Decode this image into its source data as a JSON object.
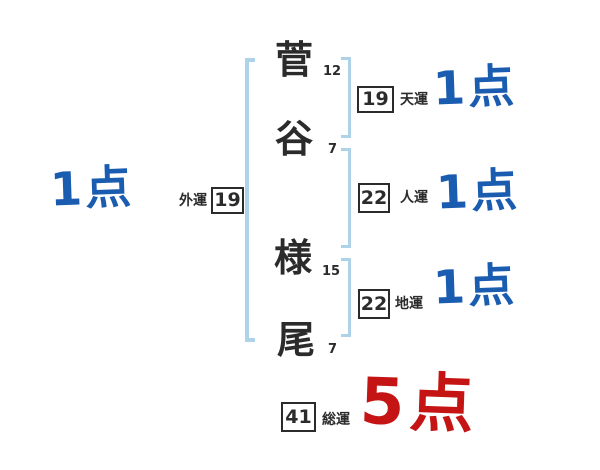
{
  "diagram": {
    "name_chars": [
      {
        "char": "菅",
        "strokes": "12"
      },
      {
        "char": "谷",
        "strokes": "7"
      },
      {
        "char": "様",
        "strokes": "15"
      },
      {
        "char": "尾",
        "strokes": "7"
      }
    ],
    "fortunes": {
      "heaven": {
        "label": "天運",
        "value": "19",
        "score": "1点"
      },
      "person": {
        "label": "人運",
        "value": "22",
        "score": "1点"
      },
      "earth": {
        "label": "地運",
        "value": "22",
        "score": "1点"
      },
      "outer": {
        "label": "外運",
        "value": "19",
        "score": "1点"
      },
      "total": {
        "label": "総運",
        "value": "41",
        "score": "5点"
      }
    },
    "colors": {
      "score_blue": "#1a5cb0",
      "score_red": "#c41414",
      "bracket_blue": "#aed3e8",
      "ink": "#2b2b2b"
    }
  }
}
